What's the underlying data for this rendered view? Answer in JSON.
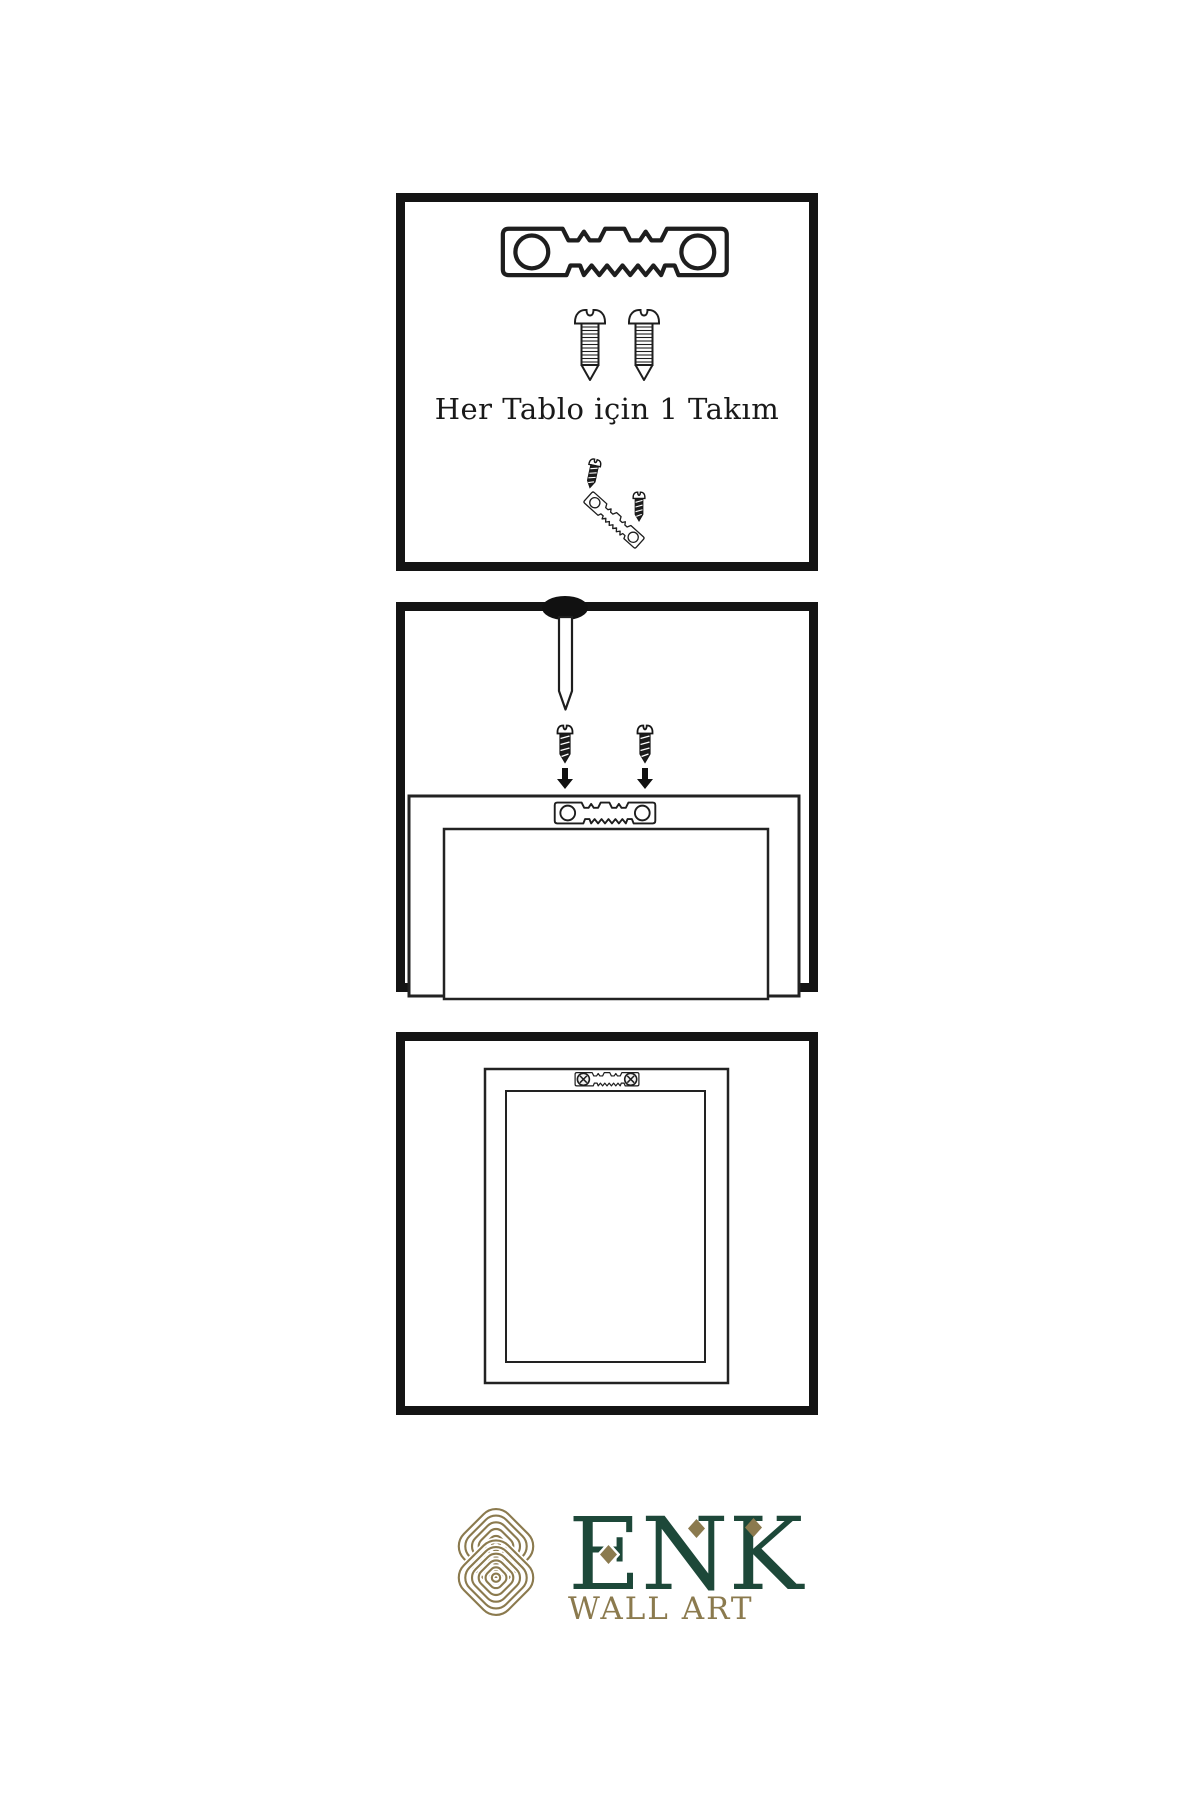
{
  "theme": {
    "gold": "#8b7a4e",
    "green": "#1d4839",
    "ink": "#1e1e1e",
    "border": "#141414",
    "bg": "#ffffff"
  },
  "panels": {
    "kit": {
      "caption": "Her Tablo için 1 Takım",
      "icons": [
        "sawtooth-hanger-icon",
        "screw-icon",
        "screw-icon",
        "dark-screw-icon",
        "tilted-sawtooth-hanger-icon",
        "dark-screw-icon"
      ]
    },
    "wall_mount": {
      "icons": [
        "nail-icon",
        "dark-screw-icon",
        "dark-screw-icon",
        "down-arrow-icon",
        "down-arrow-icon",
        "sawtooth-hanger-icon",
        "frame-back-icon"
      ]
    },
    "mounted_frame": {
      "icons": [
        "frame-back-icon",
        "sawtooth-hanger-icon",
        "phillips-screw-icon",
        "phillips-screw-icon"
      ]
    }
  },
  "logo": {
    "brand": "ENK",
    "tagline": "WALL ART",
    "mark": "interlaced-knot-icon"
  }
}
